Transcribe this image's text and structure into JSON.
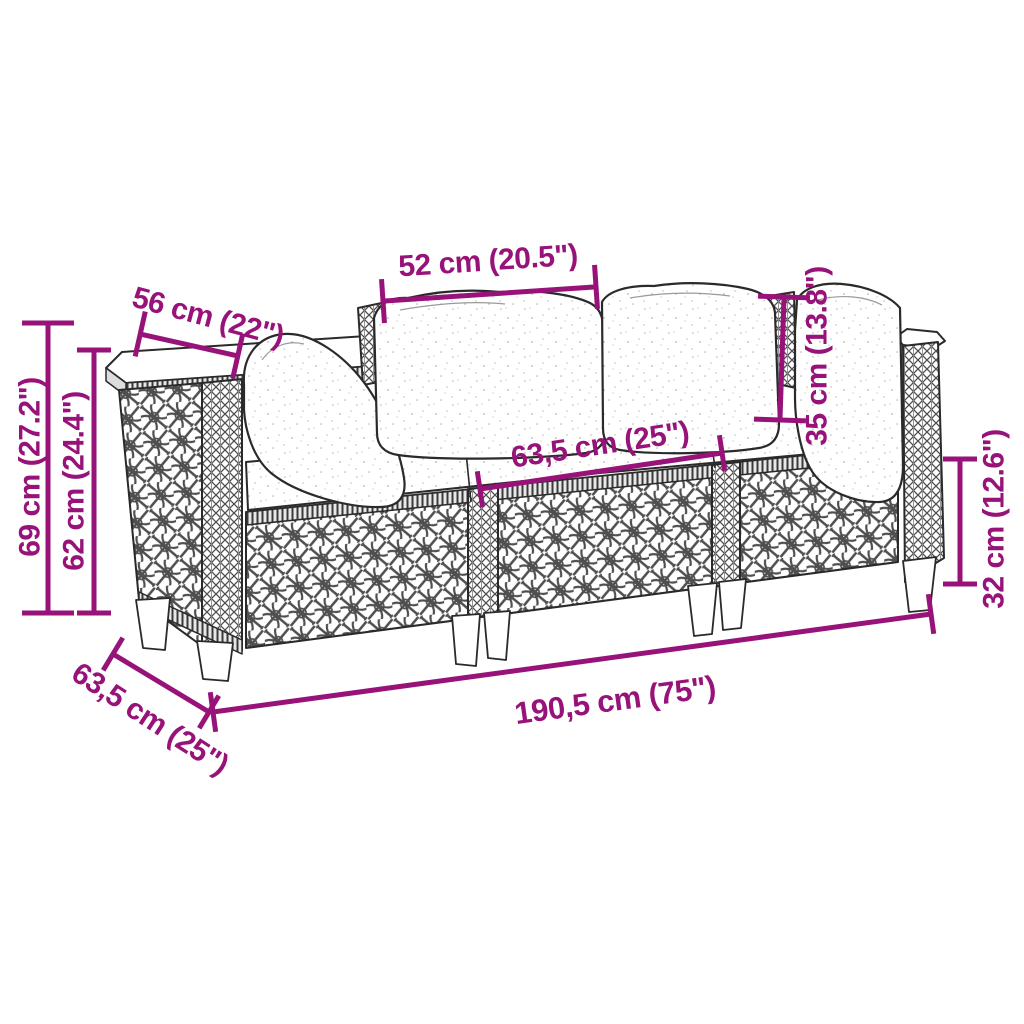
{
  "figure": {
    "type": "product-dimension-diagram",
    "subject": "rattan-garden-sofa-line-drawing"
  },
  "colors": {
    "accent": "#971279",
    "line_art": "#2a2a2a",
    "background": "#ffffff"
  },
  "dimensions": {
    "middle_backrest_width": "52 cm (20.5\")",
    "armrest_depth": "56 cm (22\")",
    "back_pillow_height": "35 cm (13.8\")",
    "overall_height": "69 cm (27.2\")",
    "armrest_height": "62 cm (24.4\")",
    "seat_cushion_width": "63,5 cm (25\")",
    "base_height": "32 cm (12.6\")",
    "overall_width": "190,5 cm (75\")",
    "overall_depth": "63,5 cm (25\")"
  }
}
